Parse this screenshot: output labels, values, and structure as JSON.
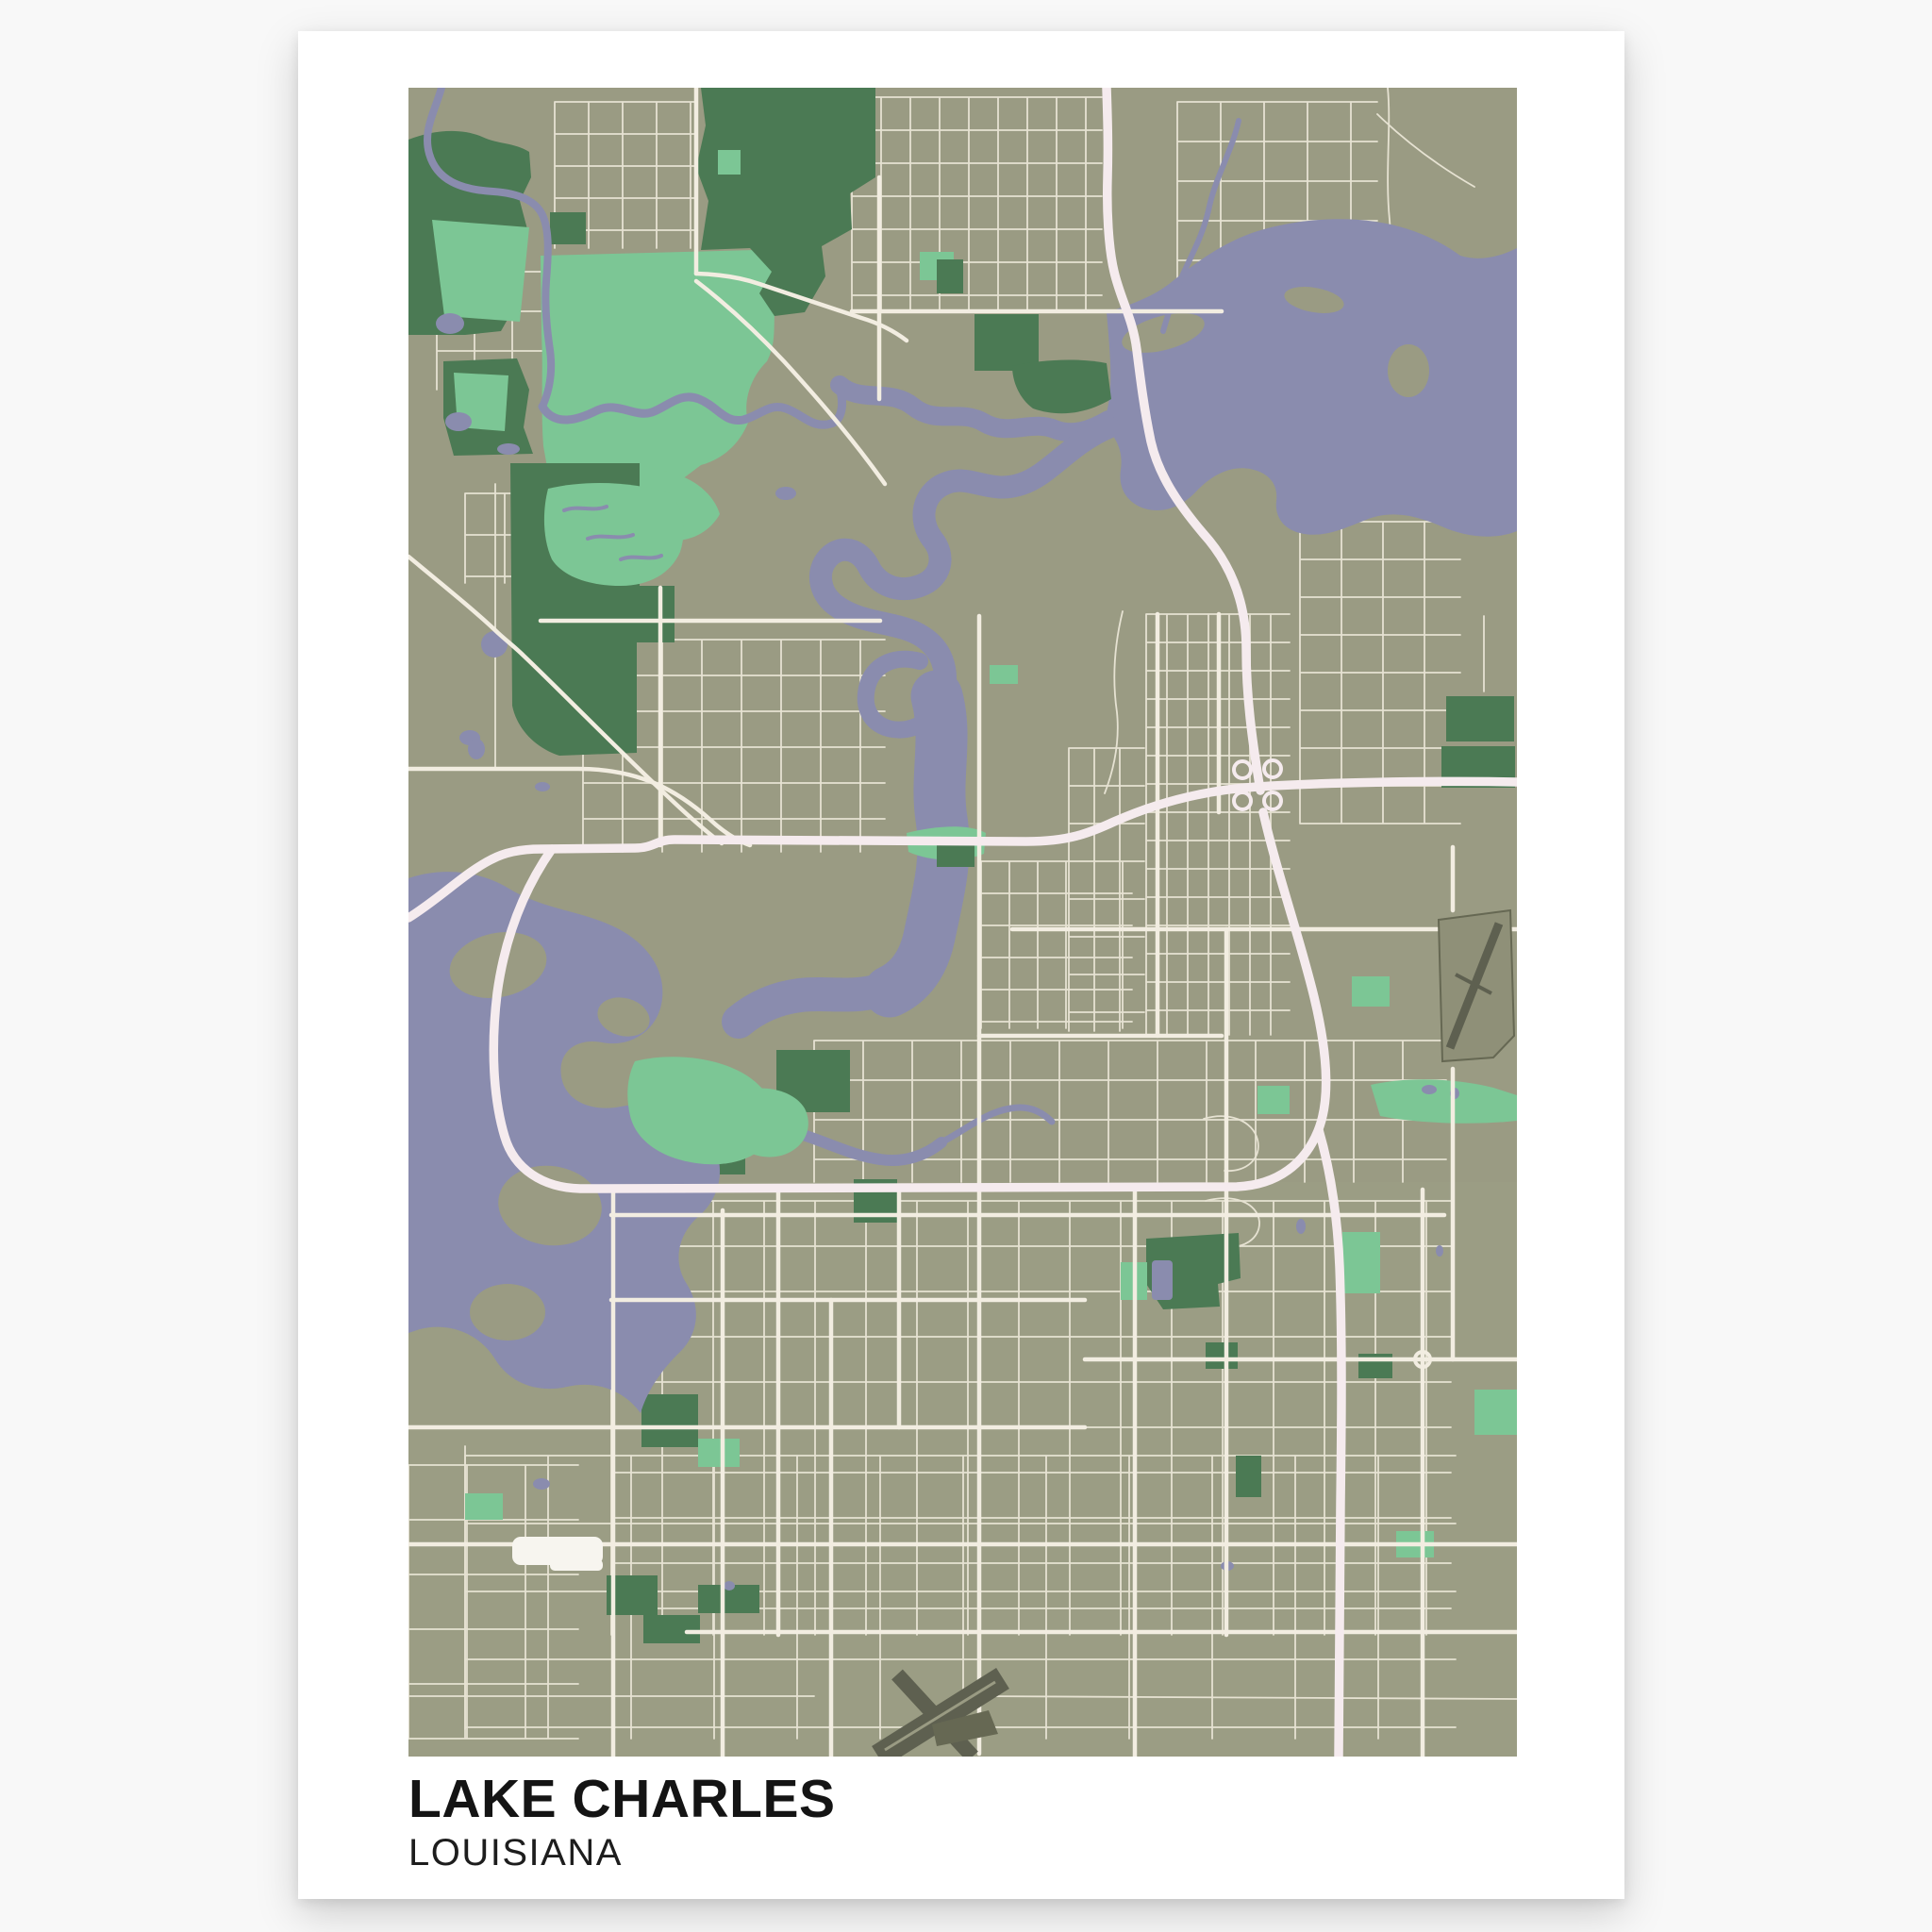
{
  "poster": {
    "title": "LAKE CHARLES",
    "subtitle": "LOUISIANA"
  },
  "colors": {
    "page_bg": "#f8f8f8",
    "poster_bg": "#ffffff",
    "title": "#141414",
    "subtitle": "#1d1d1d",
    "land": "#9a9b83",
    "land_south_tint": "#9fa086",
    "water": "#8a8cae",
    "park": "#4b7a54",
    "park_light": "#7cc695",
    "road_minor": "#e6e2d2",
    "road_major": "#f2ede1",
    "freeway": "#f5ebee",
    "runway_dark": "#5e6050",
    "runway_mid": "#8f9078",
    "runway_edge": "#666853",
    "building": "#f7f5ef"
  }
}
